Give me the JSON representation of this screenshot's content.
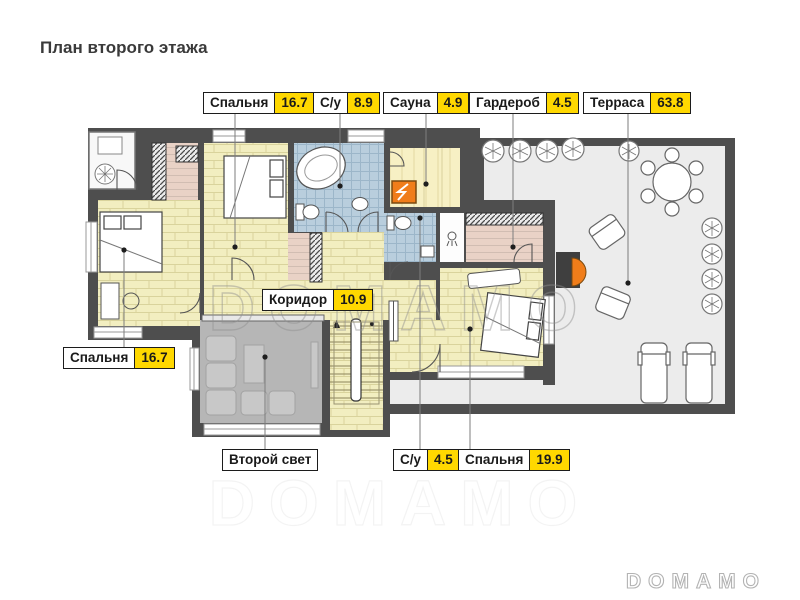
{
  "title": "План второго этажа",
  "watermark": "DOMAMO",
  "brand_logo": "DOMAMO",
  "callouts": {
    "bedroom_top": {
      "label": "Спальня",
      "value": "16.7"
    },
    "bathroom_top": {
      "label": "С/у",
      "value": "8.9"
    },
    "sauna": {
      "label": "Сауна",
      "value": "4.9"
    },
    "wardrobe": {
      "label": "Гардероб",
      "value": "4.5"
    },
    "terrace": {
      "label": "Терраса",
      "value": "63.8"
    },
    "bedroom_left": {
      "label": "Спальня",
      "value": "16.7"
    },
    "corridor": {
      "label": "Коридор",
      "value": "10.9"
    },
    "second_light": {
      "label": "Второй свет"
    },
    "bathroom_bottom": {
      "label": "С/у",
      "value": "4.5"
    },
    "bedroom_bottom": {
      "label": "Спальня",
      "value": "19.9"
    }
  },
  "colors": {
    "wall": "#4e4e4e",
    "floor-plank": "#f2eec0",
    "floor-tile": "#b9cedd",
    "floor-pink": "#e9d2c6",
    "floor-sauna": "#f7f0c4",
    "terrace": "#ececec",
    "second-light": "#b6b6b6",
    "accent-orange": "#f07d1a",
    "label-yellow": "#ffd800",
    "leader": "#7d7d7d"
  }
}
